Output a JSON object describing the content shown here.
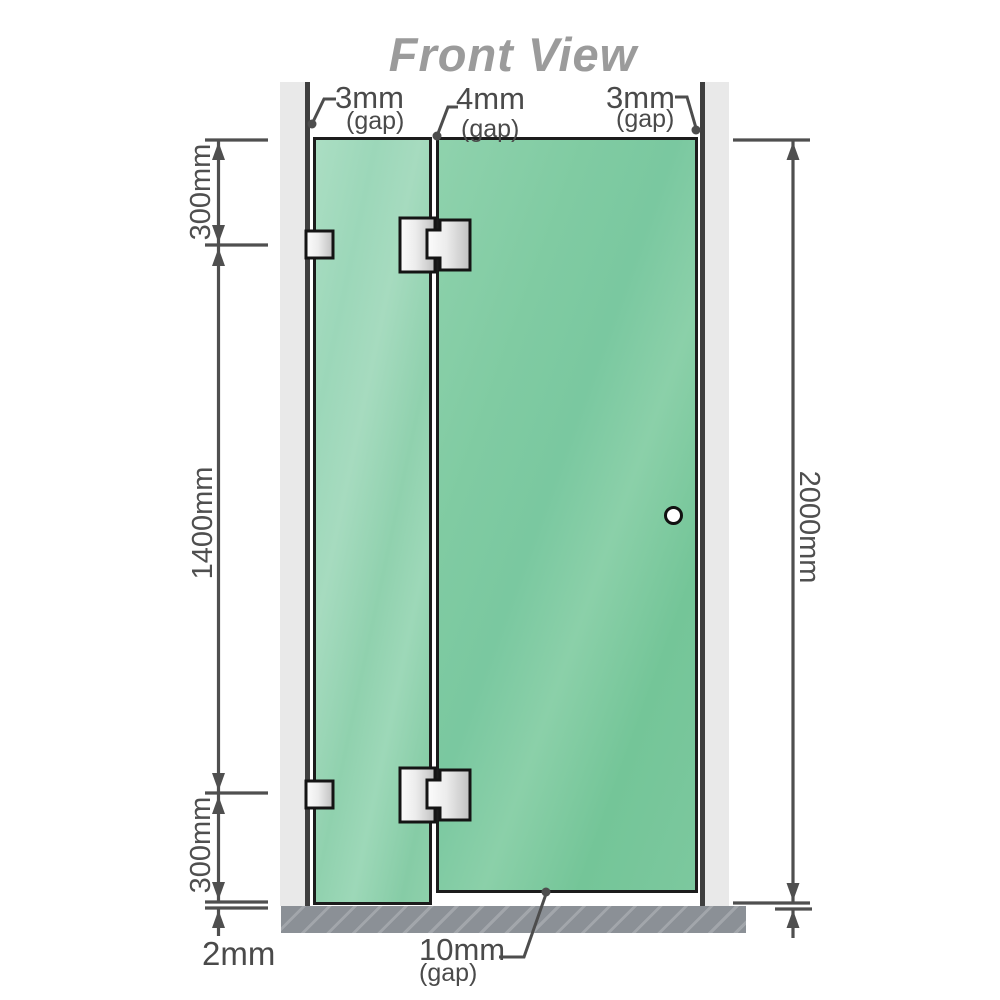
{
  "title": "Front View",
  "labels": {
    "gap_top_left": {
      "value": "3mm",
      "suffix": "(gap)"
    },
    "gap_top_middle": {
      "value": "4mm",
      "suffix": "(gap)"
    },
    "gap_top_right": {
      "value": "3mm",
      "suffix": "(gap)"
    },
    "gap_bottom": {
      "value": "10mm",
      "suffix": "(gap)"
    },
    "floor_gap": "2mm",
    "segment_top": "300mm",
    "segment_middle": "1400mm",
    "segment_bottom": "300mm",
    "total_height": "2000mm"
  },
  "colors": {
    "glass_green": "#7cc8a1",
    "glass_green_light": "#a8dcc0",
    "glass_border": "#1c1c1c",
    "wall_gray": "#e9e9e9",
    "wall_edge_dark": "#3f3f3f",
    "floor_gray": "#8b9096",
    "dimension_line_gray": "#4f4f4f",
    "label_gray": "#4a4a4a",
    "title_gray": "#9b9b9b",
    "hardware_silver": "#d9d9d9"
  }
}
